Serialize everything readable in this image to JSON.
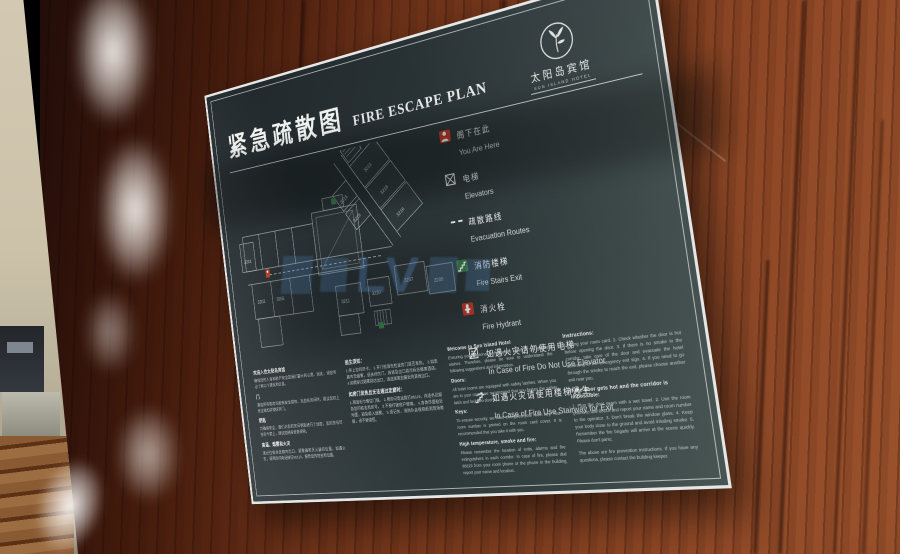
{
  "sign": {
    "title_cn": "紧急疏散图",
    "title_en": "FIRE ESCAPE PLAN",
    "logo": {
      "name_cn": "太阳岛宾馆",
      "name_en": "SUN ISLAND HOTEL"
    },
    "legend": [
      {
        "cn": "阁下在此",
        "en": "You Are Here"
      },
      {
        "cn": "电梯",
        "en": "Elevators"
      },
      {
        "cn": "疏散路线",
        "en": "Evacuation Routes"
      },
      {
        "cn": "消防楼梯",
        "en": "Fire Stairs Exit"
      },
      {
        "cn": "消火栓",
        "en": "Fire Hydrant"
      },
      {
        "cn": "如遇火灾请勿使用电梯",
        "en": "In Case of Fire Do Not Use Elevator"
      },
      {
        "cn": "如遇火灾请使用楼梯逃生",
        "en": "In Case of Fire Use Stairway for Exit"
      }
    ],
    "floor_plan": {
      "rooms": [
        "3201",
        "3203",
        "3205",
        "3207",
        "3209",
        "3211",
        "3213",
        "3215",
        "3216",
        "3218",
        "3219",
        "3220"
      ]
    },
    "info_columns": [
      {
        "blocks": [
          {
            "h": "欢迎入住太阳岛宾馆",
            "p": "确保您的人身和财产安全是我们最大的心愿。因此，请您务必了解以下建议和信息。"
          },
          {
            "h": "门",
            "p": "酒店所有客房均配有安全锁扣。当您在房间时，建议您扣上安全锁扣并锁好房门。"
          },
          {
            "h": "钥匙",
            "p": "为确保安全，我们对您的房间钥匙进行了加密。您的房号印在房卡套上，建议您随身妥善保管。"
          },
          {
            "h": "高温、烟雾和火灾",
            "p": "请记住每条走廊内出口、报警器和灭火器的位置。如遇火灾，请用房间电话拨打88119，报告您的姓名和位置。"
          }
        ]
      },
      {
        "blocks": [
          {
            "h": "逃生须知：",
            "p": "1.带上您的房卡。 2.开门前请先检查房门是否发热。 3.如走廊内无烟雾，请关好房门，按紧急出口指示标志撤离酒店。 4.如需穿过烟雾到达出口，请选择离您最近的其他出口。"
          },
          {
            "h": "如房门发热且无法通过走廊时：",
            "p": "1.用湿毛巾堵住门缝。 2.用房间电话拨打88119，向话务员报告您的姓名和房号。 3.不要打破窗户玻璃。 4.身体尽量贴近地面，避免吸入烟雾。 5.请记住，消防队会很快赶到现场救援，请不要惊慌。"
          }
        ]
      },
      {
        "blocks": [
          {
            "h": "Welcome to Sun Island Hotel",
            "p": "Ensuring your personal and property safety is our greatest wishes. Therefore, please be sure to understand the following suggestions and information."
          },
          {
            "h": "Doors:",
            "p": "All hotel rooms are equipped with safety latches. When you are in your room, we recommend that you fasten the safety latch and lock two doors."
          },
          {
            "h": "Keys:",
            "p": "To ensure security, we have encrypted your room key. Your room number is printed on the room card cover. It is recommended that you take it with you."
          },
          {
            "h": "High temperature, smoke and fire:",
            "p": "Please remember the location of exits, alarms and fire extinguishers in each corridor. In case of fire, please dial 88119 from your room phone or the phone in the building, report your name and location."
          }
        ]
      },
      {
        "blocks": [
          {
            "h": "Instructions:",
            "p": "1. Bring your room card. 2. Check whether the door is hot before opening the door. 3. If there is no smoke in the corridor, take care of the door and evacuate the hotel according to the emergency exit sign. 4. If you need to go through the smoke to reach the exit, please choose another exit near you."
          },
          {
            "h": "If the door gets hot and the corridor is impossible:",
            "p": "1. Plug the door seam with a wet towel. 2. Use the room phone to dial 88119 and report your name and room number to the operator. 3. Don't break the window glass. 4. Keep your body close to the ground and avoid inhaling smoke. 5. Remember the fire brigade will arrive at the scene quickly. Please don't panic."
          },
          {
            "p": "The above are fire prevention instructions. If you have any questions, please contact the building keeper."
          }
        ]
      }
    ]
  },
  "watermark": {
    "text": "LV"
  },
  "colors": {
    "panel": "#2a3233",
    "silver_border": "#e4e7e6",
    "accent_red": "#c23b2a",
    "accent_green": "#3f7d4e",
    "watermark_blue": "#5896d8",
    "wood": "#7d3c1e",
    "pink_wall": "#c7a29d"
  }
}
